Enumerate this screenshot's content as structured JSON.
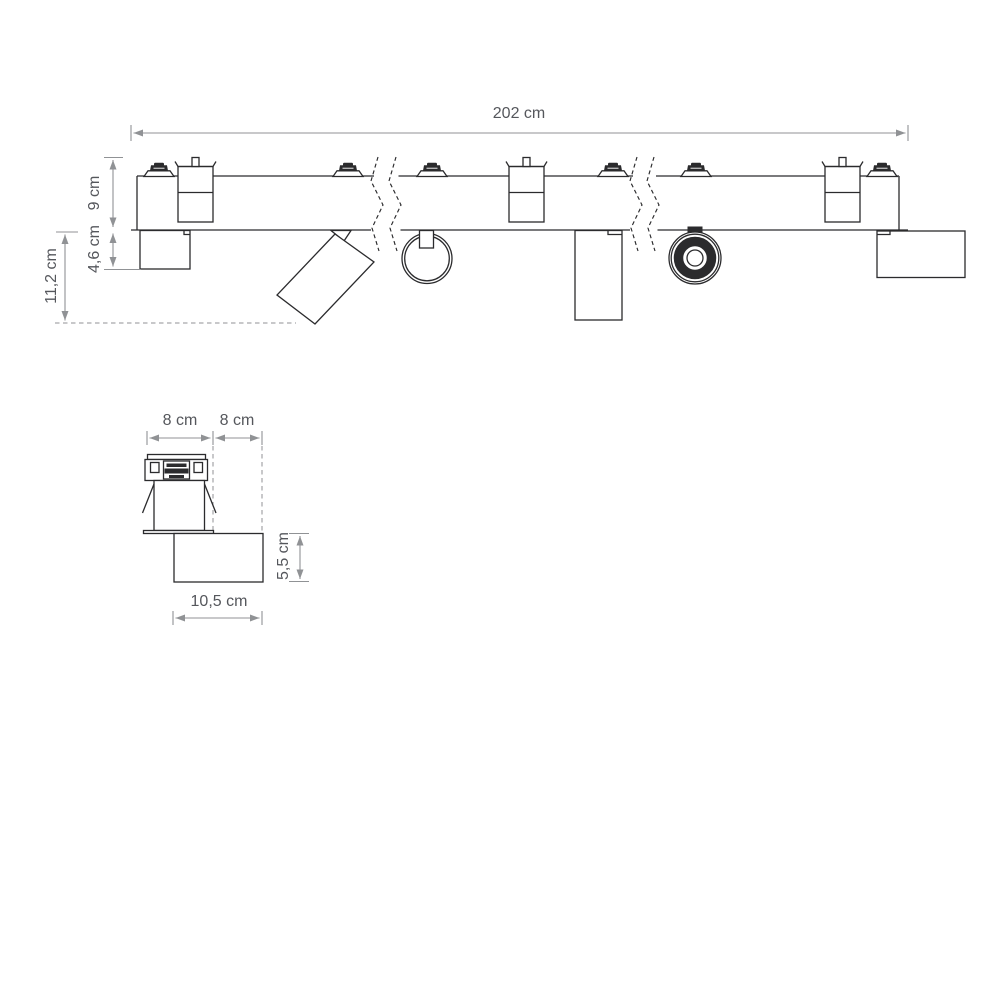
{
  "colors": {
    "ink": "#2b2b2d",
    "dimline": "#909295",
    "label": "#55575c",
    "bg": "#ffffff"
  },
  "labels": {
    "track_length": "202 cm",
    "track_height": "9 cm",
    "recess_height": "4,6 cm",
    "total_depth": "11,2 cm",
    "detail_left_width": "8 cm",
    "detail_right_width": "8 cm",
    "driver_box_height": "5,5 cm",
    "driver_box_width": "10,5 cm"
  }
}
